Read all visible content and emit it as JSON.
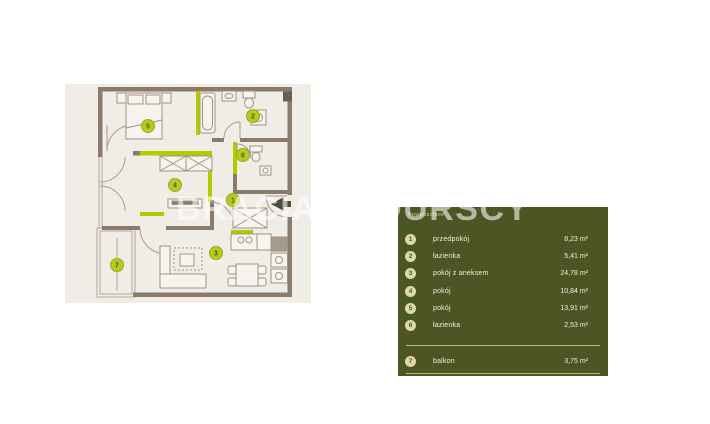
{
  "watermark": {
    "text": "BRACIA SADURSCY"
  },
  "plan": {
    "markers": [
      {
        "num": "1",
        "x": 233,
        "y": 200
      },
      {
        "num": "2",
        "x": 253,
        "y": 116
      },
      {
        "num": "3",
        "x": 216,
        "y": 253
      },
      {
        "num": "4",
        "x": 175,
        "y": 185
      },
      {
        "num": "5",
        "x": 148,
        "y": 126
      },
      {
        "num": "6",
        "x": 243,
        "y": 155
      },
      {
        "num": "7",
        "x": 117,
        "y": 265
      }
    ],
    "colors": {
      "background": "#f0ede7",
      "wall": "#8a7b6b",
      "accent_wall": "#b5c900",
      "marker_fill": "#b6ca1f",
      "entrance_arrow": "#494c38"
    }
  },
  "legend": {
    "header": "Powierzchnie",
    "panel_color": "#4c5624",
    "rows": [
      {
        "num": "1",
        "label": "przedpokój",
        "area": "8,23 m²"
      },
      {
        "num": "2",
        "label": "łazienka",
        "area": "5,41 m²"
      },
      {
        "num": "3",
        "label": "pokój z aneksem",
        "area": "24,78 m²"
      },
      {
        "num": "4",
        "label": "pokój",
        "area": "10,84 m²"
      },
      {
        "num": "5",
        "label": "pokój",
        "area": "13,91 m²"
      },
      {
        "num": "6",
        "label": "łazienka",
        "area": "2,53 m²"
      }
    ],
    "extra_rows": [
      {
        "num": "7",
        "label": "balkon",
        "area": "3,75 m²"
      }
    ]
  }
}
